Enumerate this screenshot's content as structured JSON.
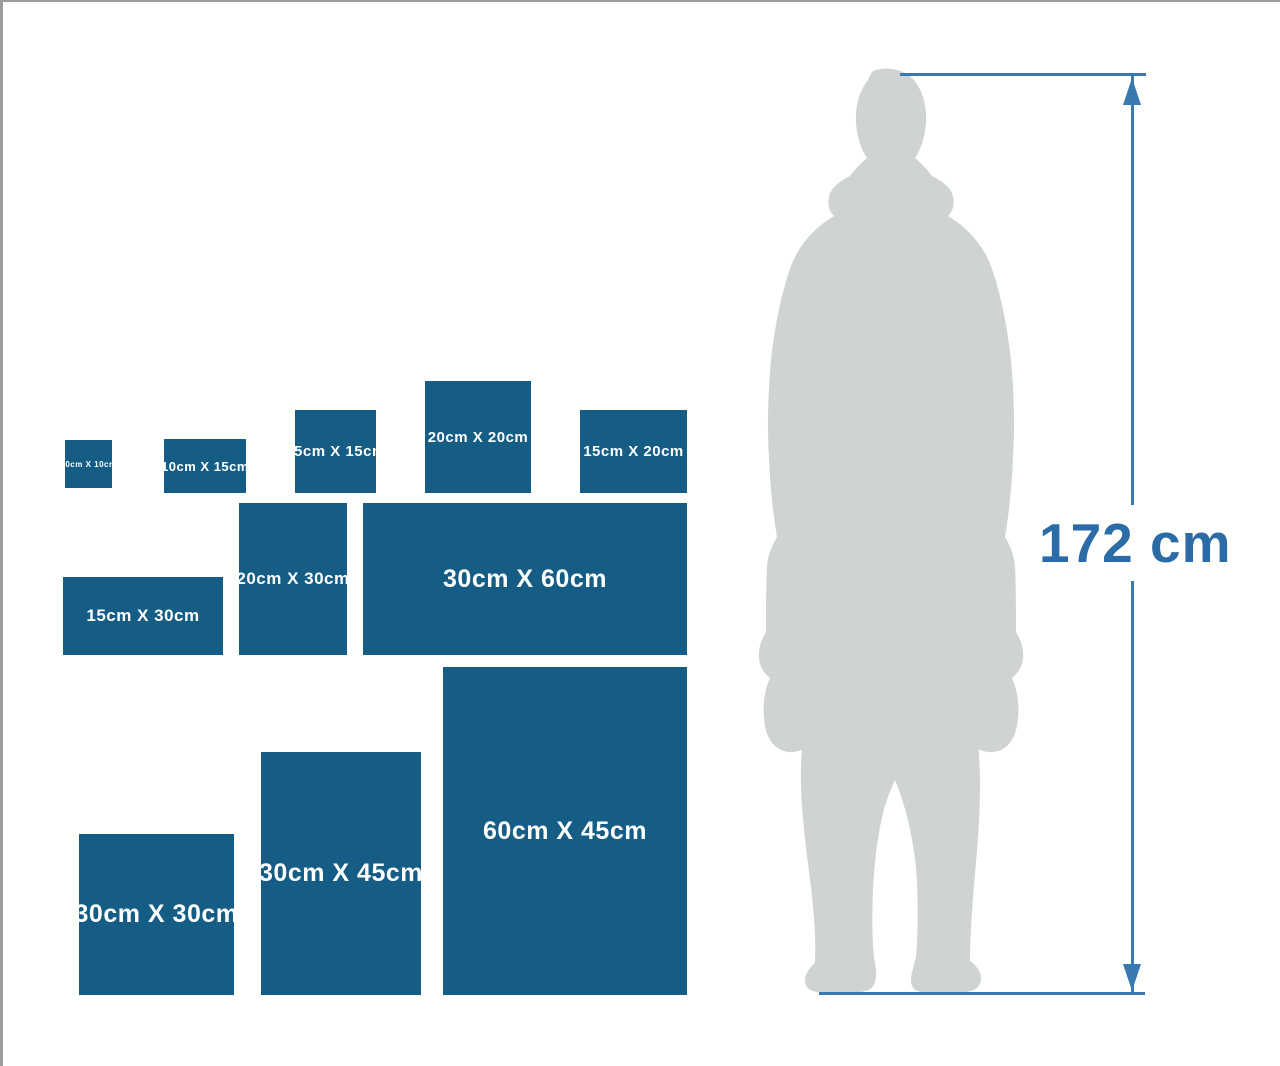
{
  "colors": {
    "box_blue": "#155d85",
    "line_blue": "#3a78b0",
    "dimension_blue": "#2b6ba6",
    "silhouette_gray": "#d0d3d4"
  },
  "person": {
    "height_label": "172 cm"
  },
  "size_boxes": [
    {
      "label": "10cm X 10cm",
      "x": 62,
      "y": 438,
      "w": 47,
      "h": 48,
      "font": 8
    },
    {
      "label": "10cm X 15cm",
      "x": 161,
      "y": 437,
      "w": 82,
      "h": 54,
      "font": 13
    },
    {
      "label": "15cm X 15cm",
      "x": 292,
      "y": 408,
      "w": 81,
      "h": 83,
      "font": 15
    },
    {
      "label": "20cm X 20cm",
      "x": 422,
      "y": 379,
      "w": 106,
      "h": 112,
      "font": 15
    },
    {
      "label": "15cm X 20cm",
      "x": 577,
      "y": 408,
      "w": 107,
      "h": 83,
      "font": 15
    },
    {
      "label": "15cm X 30cm",
      "x": 60,
      "y": 575,
      "w": 160,
      "h": 78,
      "font": 17
    },
    {
      "label": "20cm X 30cm",
      "x": 236,
      "y": 501,
      "w": 108,
      "h": 152,
      "font": 17
    },
    {
      "label": "30cm X 60cm",
      "x": 360,
      "y": 501,
      "w": 324,
      "h": 152,
      "font": 25
    },
    {
      "label": "30cm X 30cm",
      "x": 76,
      "y": 832,
      "w": 155,
      "h": 161,
      "font": 25
    },
    {
      "label": "30cm X 45cm",
      "x": 258,
      "y": 750,
      "w": 160,
      "h": 243,
      "font": 25
    },
    {
      "label": "60cm X 45cm",
      "x": 440,
      "y": 665,
      "w": 244,
      "h": 328,
      "font": 25
    }
  ],
  "dimension": {
    "top_line": {
      "x": 897,
      "y": 71,
      "length": 246
    },
    "bottom_line": {
      "x": 816,
      "y": 990,
      "length": 326
    },
    "vertical_line": {
      "x": 1128,
      "y": 74,
      "length": 916
    }
  }
}
